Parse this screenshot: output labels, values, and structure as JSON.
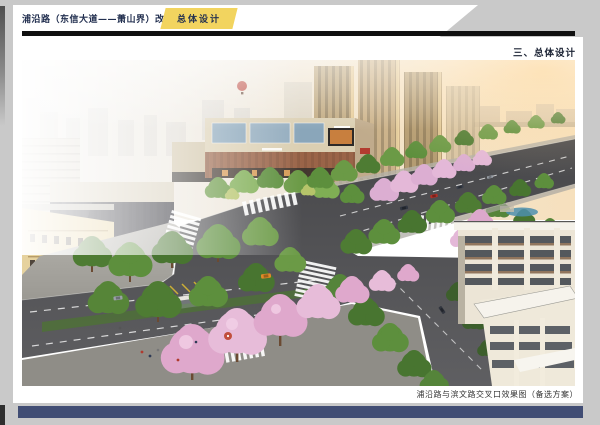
{
  "header": {
    "title": "浦沿路（东信大道——萧山界）改造提升工程",
    "tag": "总体设计"
  },
  "section": {
    "heading": "三、总体设计"
  },
  "figure": {
    "caption": "浦沿路与滨文路交叉口效果图（备选方案）"
  },
  "colors": {
    "background_gray": "#c9c9c9",
    "page_white": "#ffffff",
    "tag_yellow": "#f2d45f",
    "header_rule_black": "#101010",
    "footer_bar_navy": "#414d74",
    "title_navy": "#233050",
    "blossom_pink": "#dfa8cc",
    "tree_green": "#5d8f3d",
    "asphalt_gray": "#505052"
  }
}
